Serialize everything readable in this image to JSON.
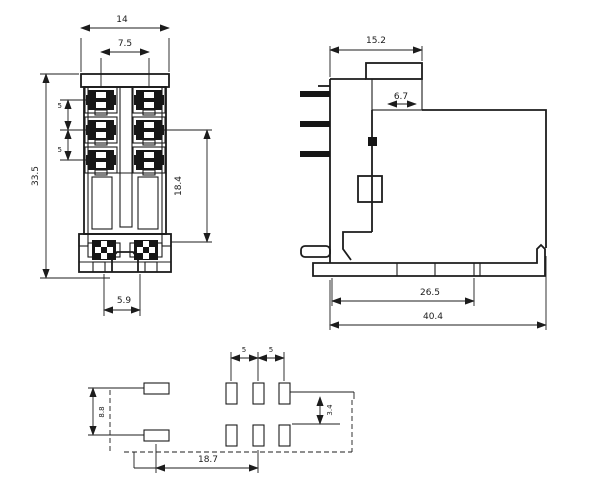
{
  "drawing": {
    "colors": {
      "line": "#1c1c1c",
      "background": "#ffffff"
    },
    "views": {
      "front": {
        "dims": {
          "overall_width": "14",
          "terminal_pitch": "7.5",
          "row_gap_a": "5",
          "row_gap_b": "5",
          "overall_height": "33.5",
          "lower_height": "18.4",
          "tab_offset": "5.9"
        }
      },
      "side": {
        "dims": {
          "upper_width": "15.2",
          "notch_width": "6.7",
          "base_length": "26.5",
          "overall_length": "40.4"
        }
      },
      "footprint": {
        "dims": {
          "col_pitch_a": "5",
          "col_pitch_b": "5",
          "row_gap": "3.4",
          "left_pad_pitch": "8.8",
          "span": "18.7"
        }
      }
    }
  }
}
